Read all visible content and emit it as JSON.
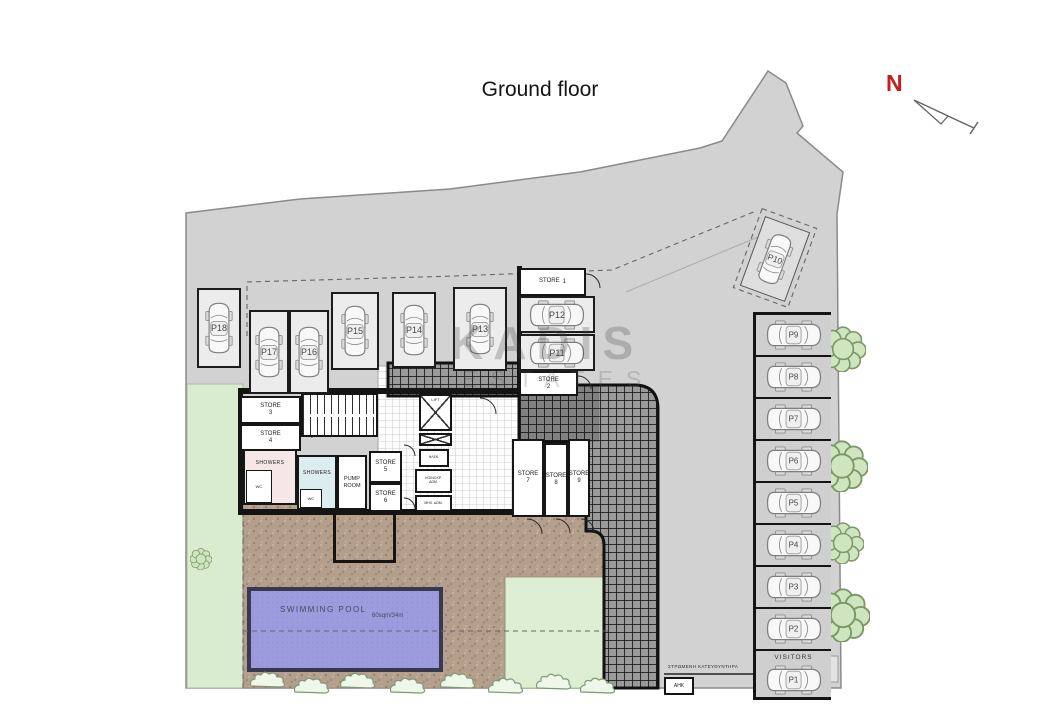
{
  "title": "Ground floor",
  "compass": {
    "north_label": "N"
  },
  "watermark": {
    "line1": "KADIS",
    "line2": "ESTATES"
  },
  "parking": {
    "visitors_label": "VISITORS",
    "spaces": {
      "p1": "P1",
      "p2": "P2",
      "p3": "P3",
      "p4": "P4",
      "p5": "P5",
      "p6": "P6",
      "p7": "P7",
      "p8": "P8",
      "p9": "P9",
      "p10": "P10",
      "p11": "P11",
      "p12": "P12",
      "p13": "P13",
      "p14": "P14",
      "p15": "P15",
      "p16": "P16",
      "p17": "P17",
      "p18": "P18"
    }
  },
  "stores": {
    "s1": {
      "name": "STORE",
      "num": "1"
    },
    "s2": {
      "name": "STORE",
      "num": "2"
    },
    "s3": {
      "name": "STORE",
      "num": "3"
    },
    "s4": {
      "name": "STORE",
      "num": "4"
    },
    "s5": {
      "name": "STORE",
      "num": "5"
    },
    "s6": {
      "name": "STORE",
      "num": "6"
    },
    "s7": {
      "name": "STORE",
      "num": "7"
    },
    "s8": {
      "name": "STORE",
      "num": "8"
    },
    "s9": {
      "name": "STORE",
      "num": "9"
    }
  },
  "rooms": {
    "showers_a": "SHOWERS",
    "showers_b": "SHOWERS",
    "pump_room": "PUMP\nROOM",
    "lift": "LIFT",
    "wc_a": "WC",
    "wc_b": "WC",
    "utility_a": "ΗΛΕΚ.",
    "utility_b": "ΚΟΙΝΟΧΡ.\nΔΩΜ.",
    "utility_c": "ΜΗΧ. ΔΩΜ."
  },
  "pool": {
    "name": "SWIMMING POOL",
    "area_note": "60sqm/34m"
  },
  "site_notes": {
    "paved_note": "ΣΤΡΩΜΕΝΗ ΚΑΤΕΥΘΥΝΤΗΡΑ",
    "substation": "ΑΗΚ"
  },
  "colors": {
    "site_gray": "#d2d2d2",
    "pool_blue": "#9b9bdd",
    "paving_brown": "#b49f8c",
    "landscape_green": "#dcead2",
    "wall_black": "#141414",
    "north_red": "#c41e1e"
  }
}
